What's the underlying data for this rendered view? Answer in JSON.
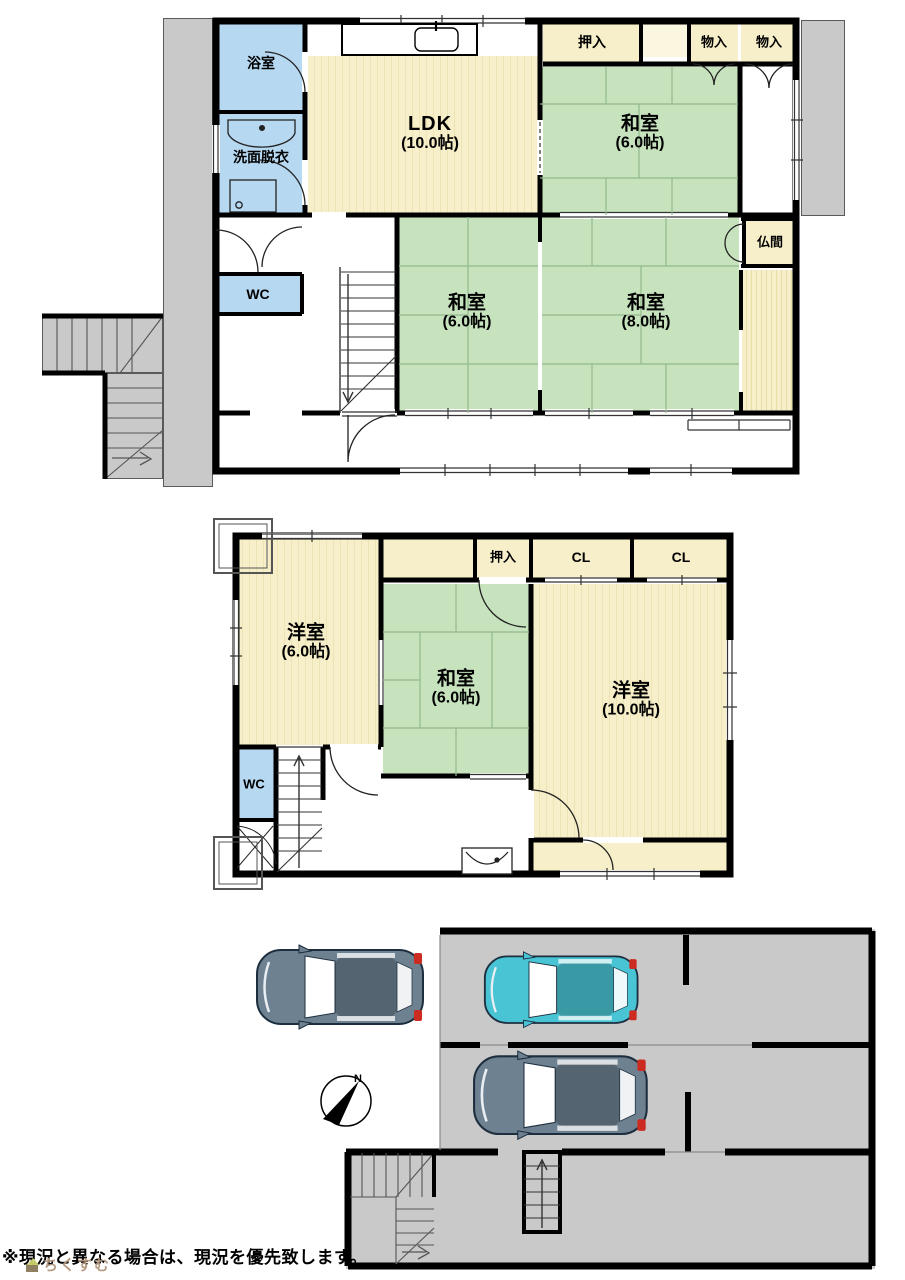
{
  "floor1": {
    "bath": "浴室",
    "washroom": "洗面脱衣",
    "ldk": {
      "name": "LDK",
      "size": "(10.0帖)"
    },
    "oshiire": "押入",
    "mono1": "物入",
    "mono2": "物入",
    "washitsu_ne": {
      "name": "和室",
      "size": "(6.0帖)"
    },
    "butsuma": "仏間",
    "washitsu_sw": {
      "name": "和室",
      "size": "(6.0帖)"
    },
    "washitsu_se": {
      "name": "和室",
      "size": "(8.0帖)"
    },
    "wc": "WC"
  },
  "floor2": {
    "yoshitsu_w": {
      "name": "洋室",
      "size": "(6.0帖)"
    },
    "oshiire": "押入",
    "cl1": "CL",
    "cl2": "CL",
    "washitsu": {
      "name": "和室",
      "size": "(6.0帖)"
    },
    "yoshitsu_e": {
      "name": "洋室",
      "size": "(10.0帖)"
    },
    "wc": "WC"
  },
  "site": {
    "compass_n": "N"
  },
  "footer": {
    "note": "※現況と異なる場合は、現況を優先致します。",
    "watermark": "ちくすむ"
  },
  "colors": {
    "room_cream": "#f6efc9",
    "tatami_green": "#c6e3be",
    "wet_blue": "#b7d8f1",
    "exterior_gray": "#c9c9c9",
    "wall_black": "#000000",
    "car_gray": "#6e8191",
    "car_cyan": "#49c4d4",
    "accent_red": "#cc2b22"
  }
}
